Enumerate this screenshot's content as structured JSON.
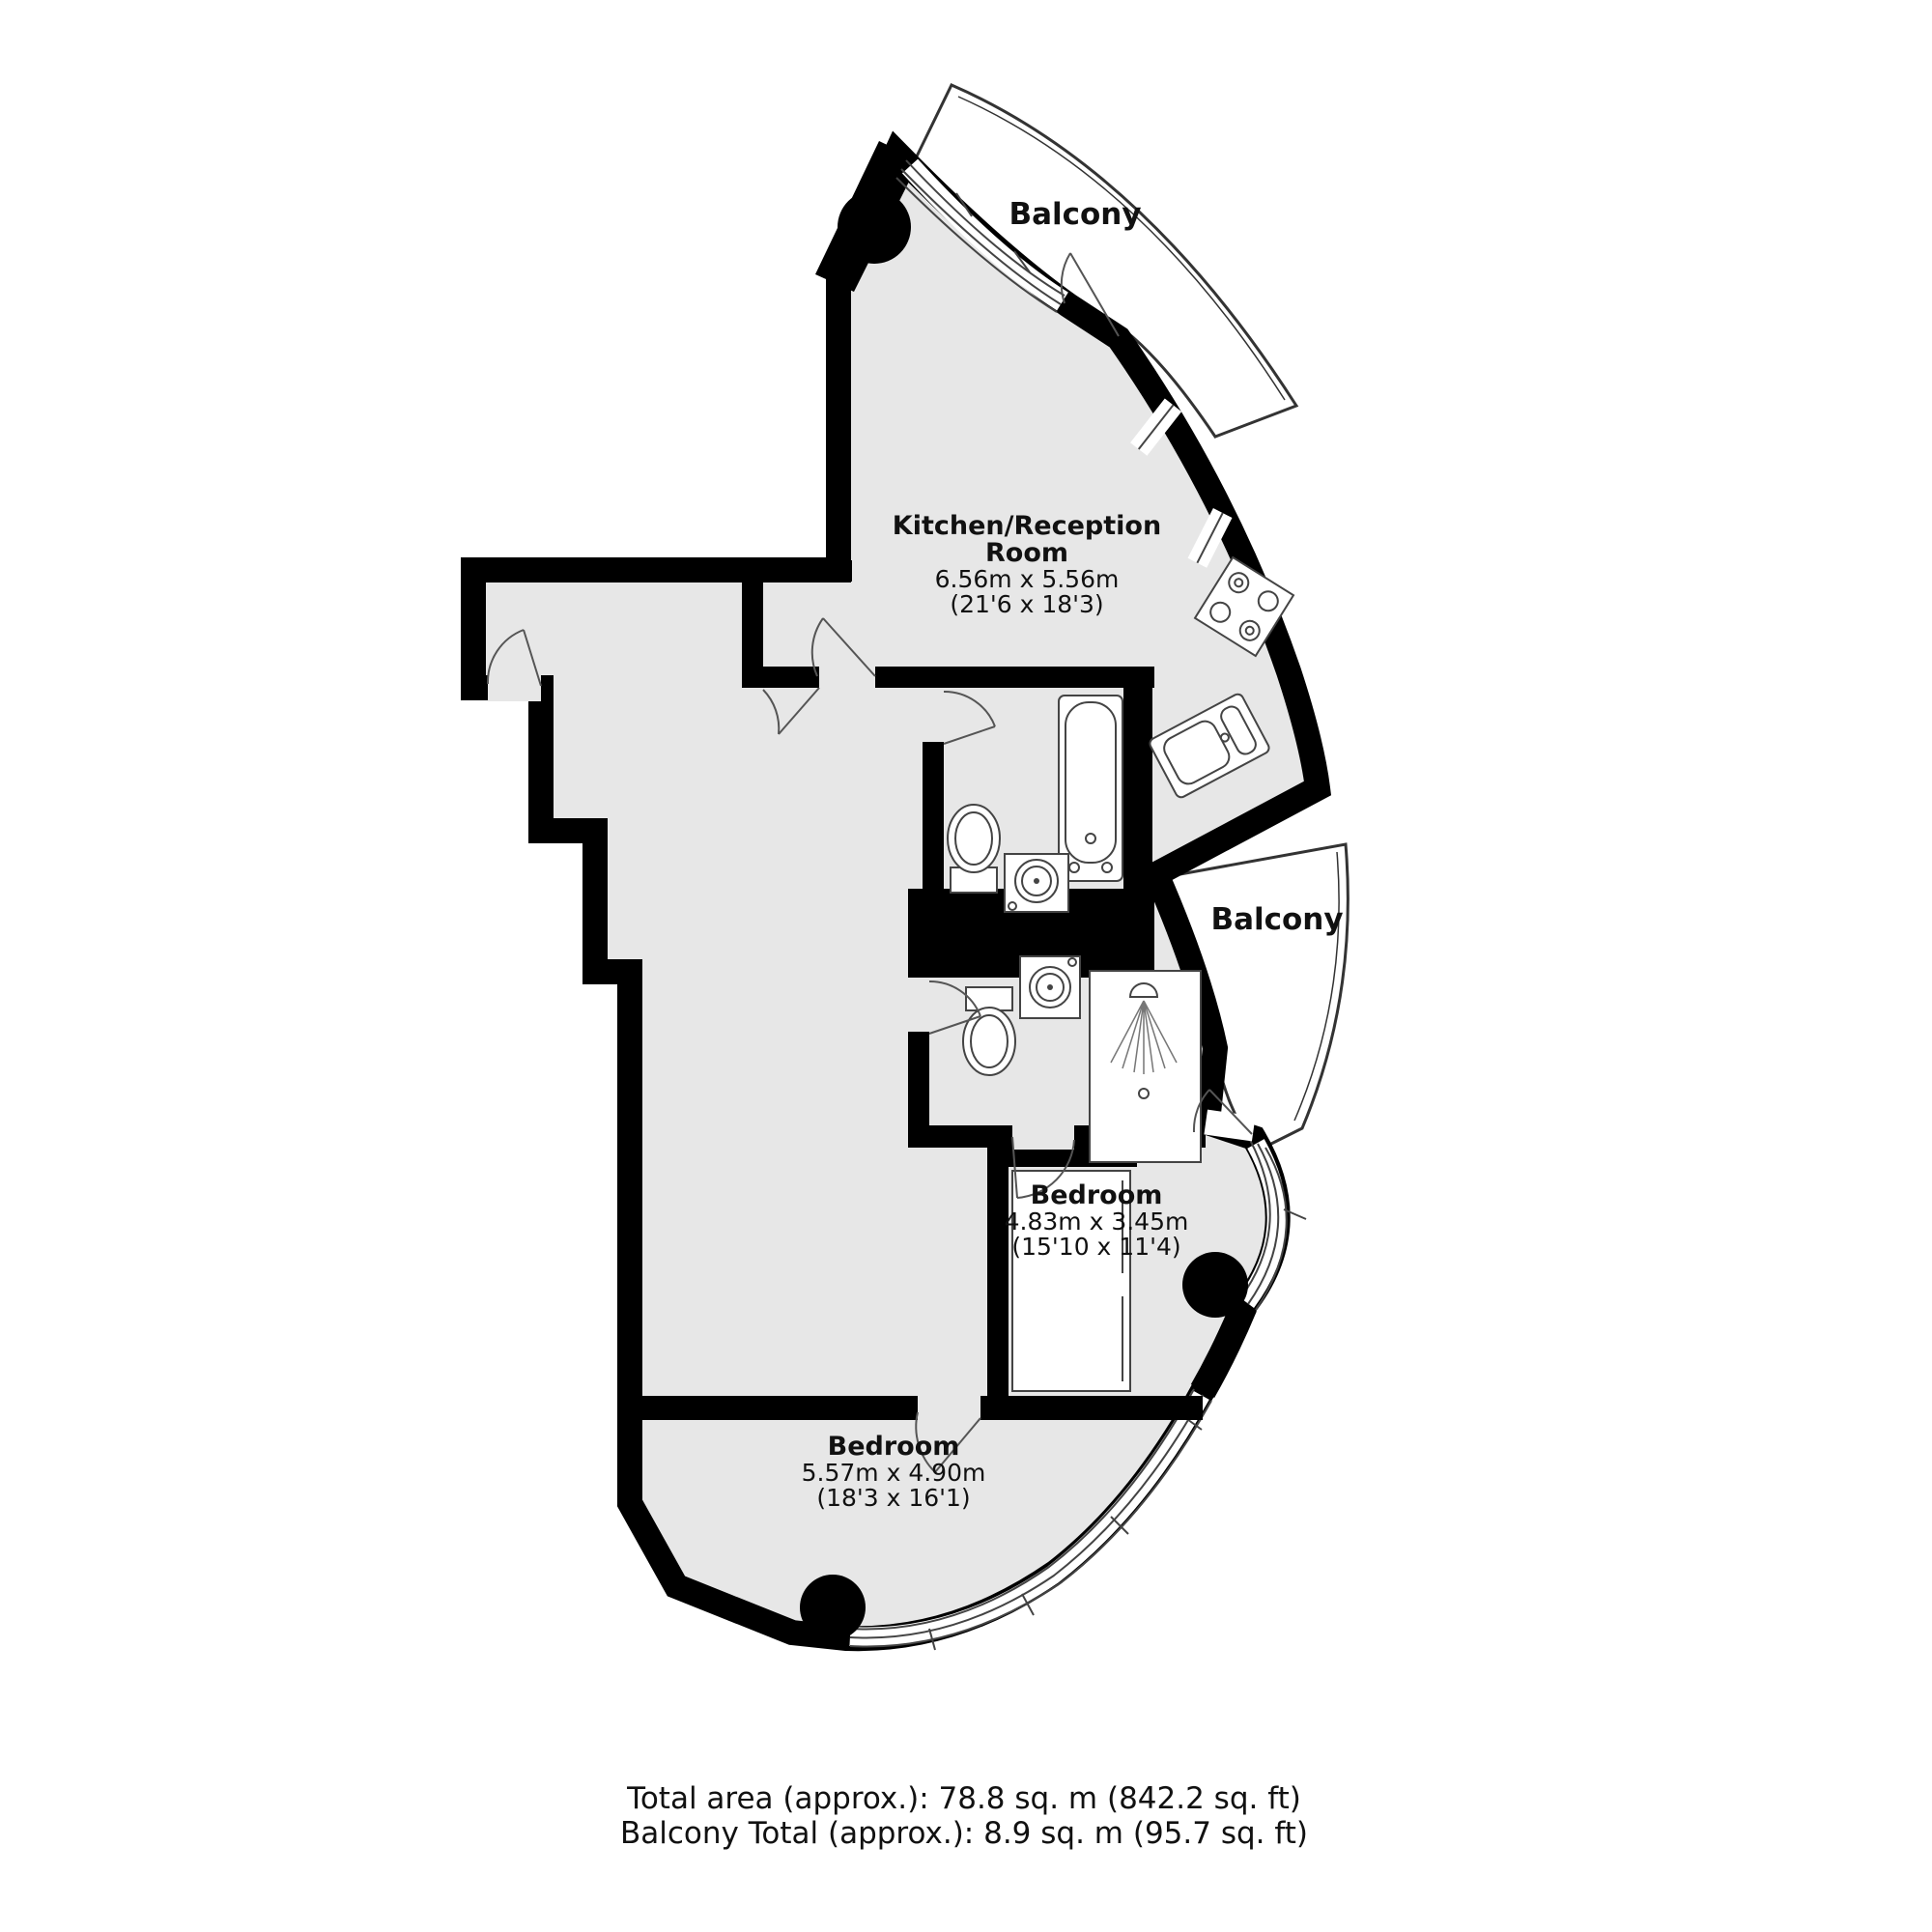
{
  "plan": {
    "balcony_top": {
      "label": "Balcony"
    },
    "balcony_mid": {
      "label": "Balcony"
    },
    "rooms": [
      {
        "id": "kitchen-reception",
        "name_line1": "Kitchen/Reception",
        "name_line2": "Room",
        "dim_metric": "6.56m x 5.56m",
        "dim_imperial": "(21'6 x 18'3)"
      },
      {
        "id": "bedroom-1",
        "name_line1": "Bedroom",
        "dim_metric": "4.83m x 3.45m",
        "dim_imperial": "(15'10 x 11'4)"
      },
      {
        "id": "bedroom-2",
        "name_line1": "Bedroom",
        "dim_metric": "5.57m x 4.90m",
        "dim_imperial": "(18'3 x 16'1)"
      }
    ],
    "fixtures": [
      "bathtub",
      "toilet",
      "basin",
      "shower",
      "kitchen-sink",
      "hob",
      "wardrobe",
      "columns"
    ]
  },
  "footer": {
    "line1": "Total area (approx.): 78.8 sq. m (842.2 sq. ft)",
    "line2": "Balcony Total (approx.): 8.9 sq. m (95.7 sq. ft)"
  },
  "colors": {
    "wall": "#000000",
    "floor": "#e7e7e7",
    "fixture_line": "#3c3c3c",
    "text": "#111111"
  }
}
